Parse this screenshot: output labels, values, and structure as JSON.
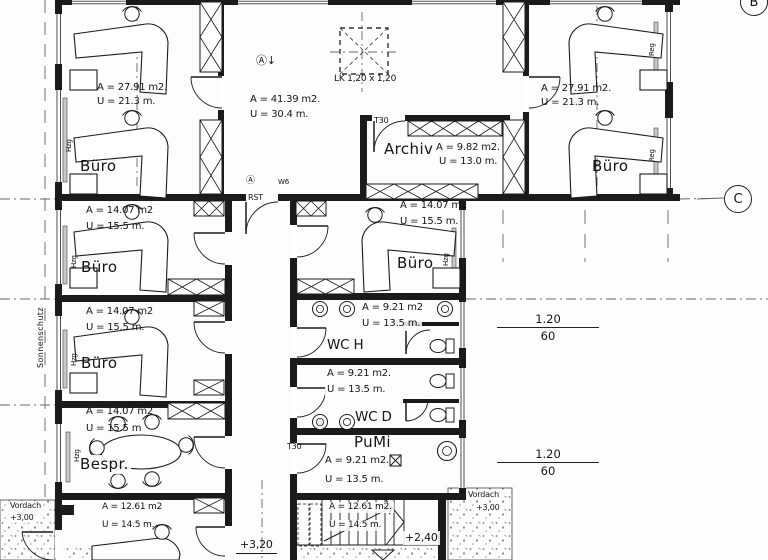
{
  "plan": {
    "grid": {
      "b": "B",
      "c": "C"
    },
    "rooms": [
      {
        "name": "Büro",
        "area": "A = 27.91 m2.",
        "per": "U = 21.3  m."
      },
      {
        "name": "",
        "area": "A = 41.39 m2.",
        "per": "U = 30.4  m."
      },
      {
        "name": "Archiv",
        "area": "A = 9.82 m2.",
        "per": "U = 13.0  m."
      },
      {
        "name": "Büro",
        "area": "A = 27.91 m2.",
        "per": "U = 21.3  m."
      },
      {
        "name": "Büro",
        "area": "A = 14.07 m2",
        "per": "U = 15.5  m."
      },
      {
        "name": "Büro",
        "area": "A = 14.07 m2",
        "per": "U = 15.5  m."
      },
      {
        "name": "Büro",
        "area": "A = 14.07 m2",
        "per": "U = 15.5  m."
      },
      {
        "name": "WC H",
        "area": "A = 9.21 m2",
        "per": "U = 13.5  m."
      },
      {
        "name": "Bespr.",
        "area": "A = 14.07 m2",
        "per": "U = 15.5  m"
      },
      {
        "name": "WC D",
        "area": "A = 9.21 m2.",
        "per": "U = 13.5  m."
      },
      {
        "name": "PuMi",
        "area": "A = 9.21 m2.",
        "per": "U = 13.5  m."
      },
      {
        "name": "",
        "area": "A = 12.61 m2",
        "per": "U = 14.5  m."
      },
      {
        "name": "",
        "area": "A = 12.61 m2.",
        "per": "U = 14.5  m."
      }
    ],
    "ann": {
      "skylight": "LK 1,20 x 1,20",
      "t30": "T30",
      "rst": "RST",
      "w6": "W6",
      "hall_symbol": "Ⓐ↓",
      "corridor_symbol": "Ⓐ",
      "sonnenschutz": "Sonnenschutz",
      "vordach": "Vordach",
      "level_plus300": "+3,00",
      "level_plus320": "+3,20",
      "level_plus240": "+2,40",
      "dim_num": "1.20",
      "dim_den": "60",
      "hzg": "Hzg",
      "reg": "Reg"
    },
    "colors": {
      "ink": "#1b1b1b",
      "paper": "#ffffff",
      "window": "#c9c9c9"
    }
  }
}
